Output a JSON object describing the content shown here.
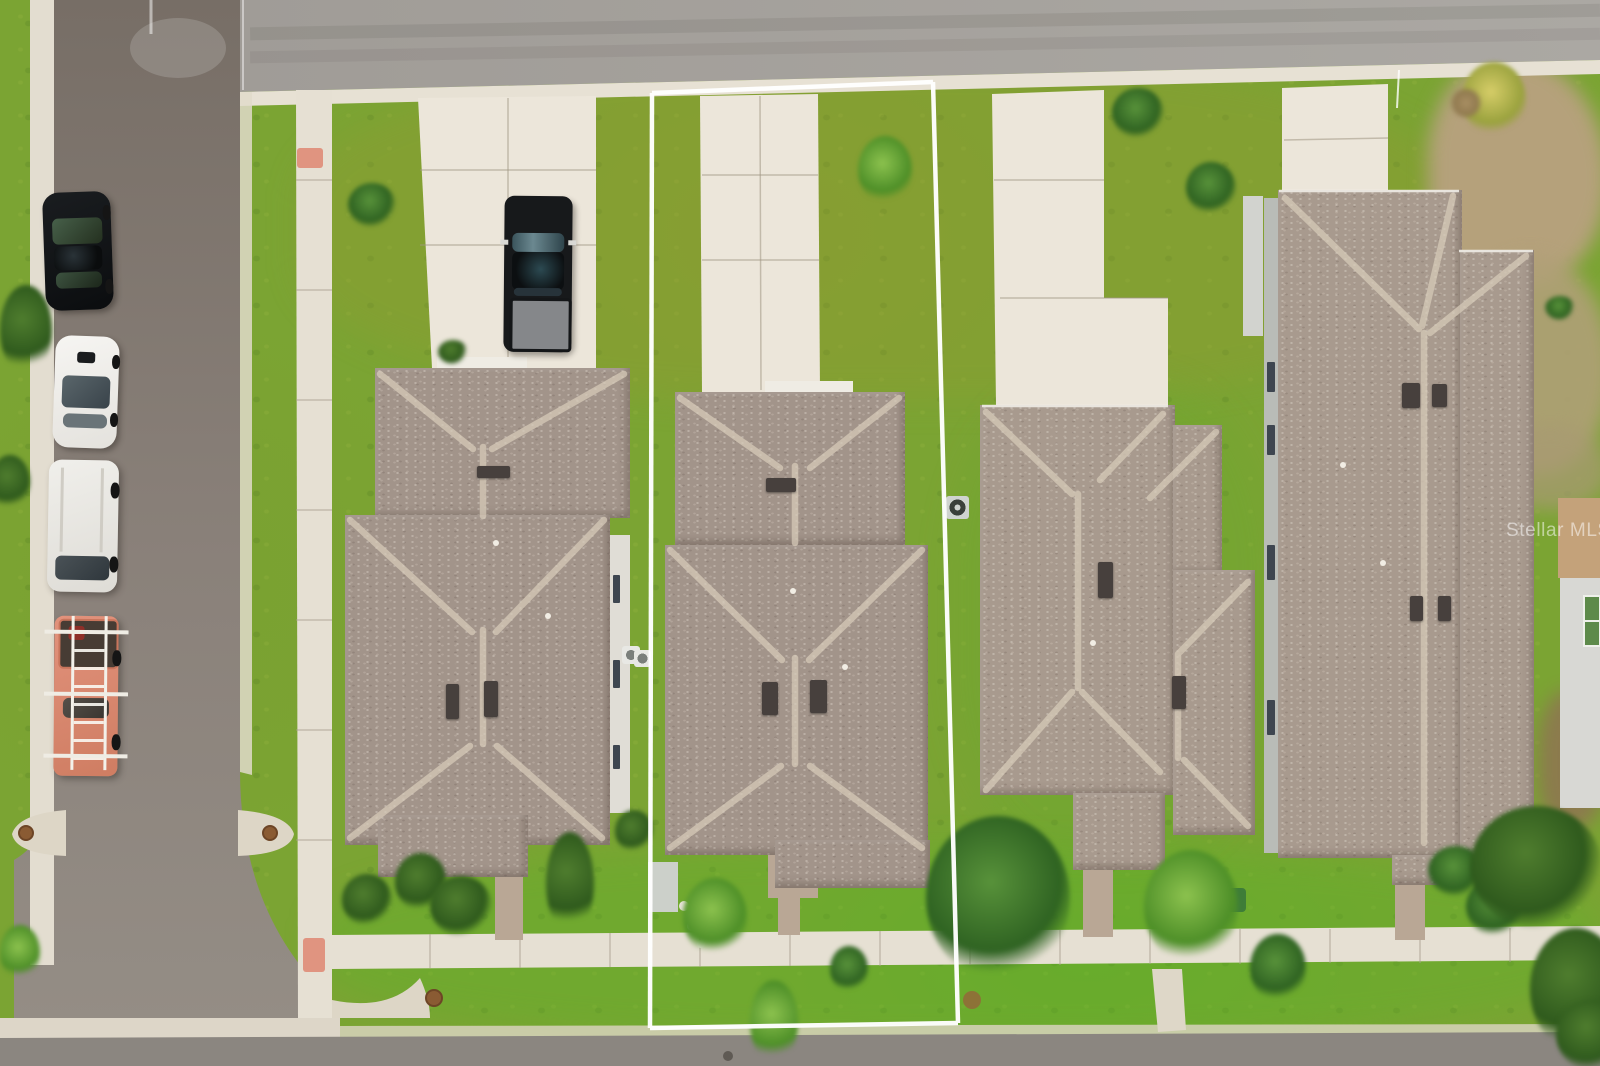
{
  "watermark": {
    "text": "Stellar MLS",
    "color": "#ffffff",
    "opacity": 0.5
  },
  "scene": {
    "type": "aerial-drone-photo",
    "subject": "top-down view of a residential street block with one property lot outlined in white",
    "lot_outline": {
      "color": "#ffffff",
      "shape": "rectangle",
      "sides": 4
    },
    "houses": [
      {
        "id": "house-left",
        "roof_color": "#a2948a",
        "features": [
          "hip roof",
          "roof vents",
          "front walkway",
          "driveway with pickup truck"
        ]
      },
      {
        "id": "house-outlined-lot",
        "roof_color": "#a2948a",
        "features": [
          "hip roof",
          "roof vents",
          "front walkway",
          "ac-unit"
        ]
      },
      {
        "id": "house-center-right",
        "roof_color": "#a89a8e",
        "features": [
          "L-shaped hip roof",
          "roof vents",
          "ac-unit",
          "front walkway"
        ]
      },
      {
        "id": "house-right-large",
        "roof_color": "#a89a8e",
        "features": [
          "long ridge roof",
          "two vent pairs",
          "white gutters"
        ]
      }
    ],
    "vehicles": [
      {
        "id": "black-pickup-truck",
        "location": "left-driveway",
        "color": "#1b1d1f"
      },
      {
        "id": "black-sedan",
        "location": "parked-on-street",
        "color": "#101316"
      },
      {
        "id": "white-sedan",
        "location": "parked-on-street",
        "color": "#f3f2ef"
      },
      {
        "id": "white-suv",
        "location": "parked-on-street",
        "color": "#edece8"
      },
      {
        "id": "utility-truck-with-ladder-rack",
        "location": "parked-on-street",
        "color": "#dd8a72"
      }
    ],
    "ground_colors": {
      "grass": "#7ba433",
      "road_top": "#a5a19c",
      "street_left": "#867d75",
      "road_bottom": "#8b8680",
      "sidewalk": "#e6e0d3",
      "driveway": "#ece6da",
      "paver_walkway": "#b9a795",
      "dry_grass_patch": "#b3a07a",
      "curb_ramp_marker": "#e09480"
    }
  }
}
